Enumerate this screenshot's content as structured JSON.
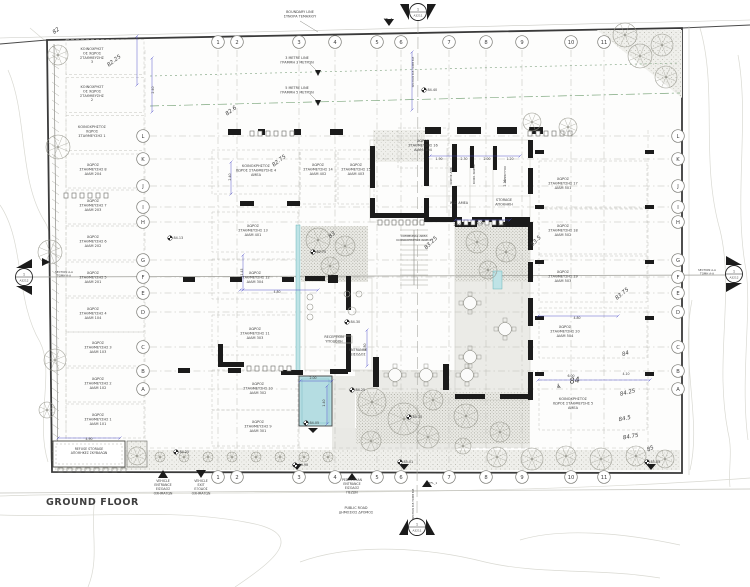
{
  "drawing": {
    "title": "GROUND FLOOR",
    "grid": {
      "columns": [
        {
          "label": "1",
          "x": 218
        },
        {
          "label": "2",
          "x": 237
        },
        {
          "label": "3",
          "x": 299
        },
        {
          "label": "4",
          "x": 335
        },
        {
          "label": "5",
          "x": 377
        },
        {
          "label": "6",
          "x": 401
        },
        {
          "label": "7",
          "x": 449
        },
        {
          "label": "8",
          "x": 486
        },
        {
          "label": "9",
          "x": 522
        },
        {
          "label": "10",
          "x": 571
        },
        {
          "label": "11",
          "x": 604
        }
      ],
      "rows": [
        {
          "label": "L",
          "y": 136
        },
        {
          "label": "K",
          "y": 159
        },
        {
          "label": "J",
          "y": 186
        },
        {
          "label": "I",
          "y": 207
        },
        {
          "label": "H",
          "y": 222
        },
        {
          "label": "G",
          "y": 260
        },
        {
          "label": "F",
          "y": 277
        },
        {
          "label": "E",
          "y": 293
        },
        {
          "label": "D",
          "y": 312
        },
        {
          "label": "C",
          "y": 347
        },
        {
          "label": "B",
          "y": 371
        },
        {
          "label": "A",
          "y": 389
        }
      ]
    },
    "parking_spaces": [
      {
        "lines": [
          "ΚΟΙΝΟΧΡΗΣΤ",
          "ΟΣ ΧΩΡΟΣ",
          "ΣΤΑΘΜΕΥΣΗΣ",
          "3"
        ],
        "x": 92,
        "y": 50,
        "bx": 105,
        "by": 57,
        "bw": 78,
        "bh": 35
      },
      {
        "lines": [
          "ΚΟΙΝΟΧΡΗΣΤ",
          "ΟΣ ΧΩΡΟΣ",
          "ΣΤΑΘΜΕΥΣΗΣ",
          "2"
        ],
        "x": 92,
        "y": 88,
        "bx": 105,
        "by": 95,
        "bw": 78,
        "bh": 35
      },
      {
        "lines": [
          "ΚΟΙΝΟΧΡΗΣΤΟΣ",
          "ΧΩΡΟΣ",
          "ΣΤΑΘΜΕΥΣΗΣ 1"
        ],
        "x": 92,
        "y": 128,
        "bx": 105,
        "by": 133,
        "bw": 78,
        "bh": 35
      },
      {
        "lines": [
          "ΧΩΡΟΣ",
          "ΣΤΑΘΜΕΥΣΗΣ 8",
          "ΔΙΑΜ 204"
        ],
        "x": 93,
        "y": 166,
        "bx": 105,
        "by": 171,
        "bw": 78,
        "bh": 34
      },
      {
        "lines": [
          "ΧΩΡΟΣ",
          "ΣΤΑΘΜΕΥΣΗΣ 7",
          "ΔΙΑΜ 203"
        ],
        "x": 93,
        "y": 202,
        "bx": 105,
        "by": 207,
        "bw": 78,
        "bh": 34
      },
      {
        "lines": [
          "ΧΩΡΟΣ",
          "ΣΤΑΘΜΕΥΣΗΣ 6",
          "ΔΙΑΜ 202"
        ],
        "x": 93,
        "y": 238,
        "bx": 105,
        "by": 243,
        "bw": 78,
        "bh": 34
      },
      {
        "lines": [
          "ΧΩΡΟΣ",
          "ΣΤΑΘΜΕΥΣΗΣ 5",
          "ΔΙΑΜ 201"
        ],
        "x": 93,
        "y": 274,
        "bx": 105,
        "by": 279,
        "bw": 78,
        "bh": 34
      },
      {
        "lines": [
          "ΧΩΡΟΣ",
          "ΣΤΑΘΜΕΥΣΗΣ 4",
          "ΔΙΑΜ 104"
        ],
        "x": 93,
        "y": 310,
        "bx": 105,
        "by": 315,
        "bw": 78,
        "bh": 34
      },
      {
        "lines": [
          "ΧΩΡΟΣ",
          "ΣΤΑΘΜΕΥΣΗΣ 3",
          "ΔΙΑΜ 103"
        ],
        "x": 98,
        "y": 344,
        "bx": 105,
        "by": 349,
        "bw": 78,
        "bh": 34
      },
      {
        "lines": [
          "ΧΩΡΟΣ",
          "ΣΤΑΘΜΕΥΣΗΣ 2",
          "ΔΙΑΜ 102"
        ],
        "x": 98,
        "y": 380,
        "bx": 105,
        "by": 385,
        "bw": 78,
        "bh": 34
      },
      {
        "lines": [
          "ΧΩΡΟΣ",
          "ΣΤΑΘΜΕΥΣΗΣ 1",
          "ΔΙΑΜ 101"
        ],
        "x": 98,
        "y": 416,
        "bx": 105,
        "by": 421,
        "bw": 78,
        "bh": 34
      },
      {
        "lines": [
          "ΚΟΙΝΟΧΡΗΣΤΟΣ",
          "ΧΩΡΟΣ ΣΤΑΘΜΕΥΣΗΣ 4",
          "ΑΜΕΑ"
        ],
        "x": 256,
        "y": 167,
        "bx": 256,
        "by": 172,
        "bw": 88,
        "bh": 44
      },
      {
        "lines": [
          "ΧΩΡΟΣ",
          "ΣΤΑΘΜΕΥΣΗΣ 14",
          "ΔΙΑΜ 402"
        ],
        "x": 318,
        "y": 166,
        "bx": 318,
        "by": 177,
        "bw": 36,
        "bh": 54
      },
      {
        "lines": [
          "ΧΩΡΟΣ",
          "ΣΤΑΘΜΕΥΣΗΣ 15",
          "ΔΙΑΜ 403"
        ],
        "x": 356,
        "y": 166,
        "bx": 356,
        "by": 177,
        "bw": 36,
        "bh": 54
      },
      {
        "lines": [
          "ΧΩΡΟΣ",
          "ΣΤΑΘΜΕΥΣΗΣ 16",
          "ΔΙΑΜ. 404"
        ],
        "x": 423,
        "y": 142,
        "bx": 423,
        "by": 148,
        "bw": 50,
        "bh": 40
      },
      {
        "lines": [
          "ΧΩΡΟΣ",
          "ΣΤΑΘΜΕΥΣΗΣ 13",
          "ΔΙΑΜ 401"
        ],
        "x": 253,
        "y": 227,
        "bx": 255,
        "by": 232,
        "bw": 86,
        "bh": 40
      },
      {
        "lines": [
          "ΧΩΡΟΣ",
          "ΣΤΑΘΜΕΥΣΗΣ 12",
          "ΔΙΑΜ 304"
        ],
        "x": 255,
        "y": 274,
        "bx": 255,
        "by": 279,
        "bw": 86,
        "bh": 40
      },
      {
        "lines": [
          "ΧΩΡΟΣ",
          "ΣΤΑΘΜΕΥΣΗΣ 11",
          "ΔΙΑΜ 303"
        ],
        "x": 255,
        "y": 330,
        "bx": 255,
        "by": 335,
        "bw": 86,
        "bh": 40
      },
      {
        "lines": [
          "ΧΩΡΟΣ",
          "ΣΤΑΘΜΕΥΣΗΣ 10",
          "ΔΙΑΜ 302"
        ],
        "x": 258,
        "y": 385,
        "bx": 255,
        "by": 390,
        "bw": 86,
        "bh": 40
      },
      {
        "lines": [
          "ΧΩΡΟΣ",
          "ΣΤΑΘΜΕΥΣΗΣ 9",
          "ΔΙΑΜ 301"
        ],
        "x": 258,
        "y": 423,
        "bx": 255,
        "by": 428,
        "bw": 86,
        "bh": 36
      },
      {
        "lines": [
          "ΧΩΡΟΣ",
          "ΣΤΑΘΜΕΥΣΗΣ 17",
          "ΔΙΑΜ 501"
        ],
        "x": 563,
        "y": 180,
        "bx": 593,
        "by": 185,
        "bw": 108,
        "bh": 48
      },
      {
        "lines": [
          "ΧΩΡΟΣ",
          "ΣΤΑΘΜΕΥΣΗΣ 18",
          "ΔΙΑΜ 502"
        ],
        "x": 563,
        "y": 227,
        "bx": 593,
        "by": 232,
        "bw": 108,
        "bh": 48
      },
      {
        "lines": [
          "ΧΩΡΟΣ",
          "ΣΤΑΘΜΕΥΣΗΣ 19",
          "ΔΙΑΜ 503"
        ],
        "x": 563,
        "y": 273,
        "bx": 593,
        "by": 278,
        "bw": 108,
        "bh": 48
      },
      {
        "lines": [
          "ΧΩΡΟΣ",
          "ΣΤΑΘΜΕΥΣΗΣ 20",
          "ΔΙΑΜ 504"
        ],
        "x": 565,
        "y": 328,
        "bx": 593,
        "by": 333,
        "bw": 108,
        "bh": 50
      },
      {
        "lines": [
          "ΚΟΙΝΟΧΡΗΣΤΟΣ",
          "ΧΩΡΟΣ ΣΤΑΘΜΕΥΣΗΣ 5",
          "ΑΜΕΑ"
        ],
        "x": 573,
        "y": 400,
        "bx": 593,
        "by": 405,
        "bw": 108,
        "bh": 50
      }
    ],
    "labels": [
      {
        "name": "boundary-line-label",
        "lines": [
          "BOUNDARY LINE",
          "ΣΥΝΟΡΑ ΤΕΜΑΧΙΟΥ"
        ],
        "x": 300,
        "y": 13
      },
      {
        "name": "three-metre-line-label",
        "lines": [
          "3 METRE LINE",
          "ΓΡΑΜΜΗ 3 ΜΕΤΡΩΝ"
        ],
        "x": 297,
        "y": 59
      },
      {
        "name": "five-metre-line-label",
        "lines": [
          "5 METRE LINE",
          "ΓΡΑΜΜΗ 5 ΜΕΤΡΩΝ"
        ],
        "x": 297,
        "y": 89
      },
      {
        "name": "refuse-storage-label",
        "lines": [
          "REFUSE STORAGE",
          "ΑΠΟΘΗΚΕΣ ΣΚΥΒΑΛΩΝ"
        ],
        "x": 89,
        "y": 450,
        "size": 3.2
      },
      {
        "name": "reception-label",
        "lines": [
          "RECEPTION",
          "ΥΠΟΔΟΧΗ"
        ],
        "x": 334,
        "y": 338
      },
      {
        "name": "entrance-label",
        "lines": [
          "ENTRANCE",
          "ΕΙΣΟΔΟΣ"
        ],
        "x": 358,
        "y": 351
      },
      {
        "name": "storage-label",
        "lines": [
          "STORAGE",
          "ΑΠΟΘΗΚΗ"
        ],
        "x": 504,
        "y": 201
      },
      {
        "name": "wc-amea-label",
        "lines": [
          "W.C. ΑΜΕΑ"
        ],
        "x": 459,
        "y": 204
      },
      {
        "name": "communal-area-label",
        "lines": [
          "COMMUNAL AREA",
          "ΚΟΙΝΟΧΡΗΣΤΟΣ ΧΩΡΟΣ"
        ],
        "x": 414,
        "y": 237,
        "size": 3.0
      },
      {
        "name": "ahk-room-label",
        "lines": [
          "ΧΩΡΟΣ ΑΗΚ"
        ],
        "x": 452,
        "y": 176,
        "rot": -90,
        "size": 3.0
      },
      {
        "name": "koin-room-label",
        "lines": [
          "ΚΟΙΝ. ΧΩΡΟΣ"
        ],
        "x": 475,
        "y": 174,
        "rot": -90,
        "size": 3.0
      },
      {
        "name": "elek-room-label",
        "lines": [
          "ΗΛΕΚΤΥΟΣ"
        ],
        "x": 506,
        "y": 174,
        "rot": -90,
        "size": 3.0
      },
      {
        "name": "vehicle-entrance-label",
        "lines": [
          "VEHICLE",
          "ENTRANCE",
          "ΕΙΣΟΔΟΣ",
          "ΟΧΗΜΑΤΩΝ"
        ],
        "x": 163,
        "y": 482,
        "size": 3.2
      },
      {
        "name": "vehicle-exit-label",
        "lines": [
          "VEHICLE",
          "EXIT",
          "ΕΞΟΔΟΣ",
          "ΟΧΗΜΑΤΩΝ"
        ],
        "x": 201,
        "y": 482,
        "size": 3.2
      },
      {
        "name": "pedestrian-entrance-label",
        "lines": [
          "PEDESTRIAN",
          "ENTRANCE",
          "ΕΙΣΟΔΟΣ",
          "ΠΕΖΩΝ"
        ],
        "x": 352,
        "y": 481,
        "size": 3.2
      },
      {
        "name": "public-road-label",
        "lines": [
          "PUBLIC ROAD",
          "ΔΗΜΟΣΙΟΣ ΔΡΟΜΟΣ"
        ],
        "x": 356,
        "y": 509
      },
      {
        "name": "section-aa-left-label",
        "lines": [
          "SECTION A-A",
          "ΤΟΜΗ A-A"
        ],
        "x": 64,
        "y": 273,
        "size": 2.8
      },
      {
        "name": "section-aa-right-label",
        "lines": [
          "SECTION A-A",
          "ΤΟΜΗ A-A"
        ],
        "x": 707,
        "y": 271,
        "size": 2.8
      },
      {
        "name": "section-bb-top-label",
        "lines": [
          "SECTION B-B  ΤΟΜΗ B-B"
        ],
        "x": 414,
        "y": 72,
        "rot": -90,
        "size": 2.6
      },
      {
        "name": "section-bb-bottom-label",
        "lines": [
          "SECTION B-B  ΤΟΜΗ B-B"
        ],
        "x": 414,
        "y": 504,
        "rot": -90,
        "size": 2.6
      },
      {
        "name": "tfl3-label",
        "lines": [
          "TFL_3"
        ],
        "x": 388,
        "y": 20,
        "size": 3.0
      },
      {
        "name": "tfl1-label",
        "lines": [
          "TFL_1"
        ],
        "x": 433,
        "y": 484,
        "size": 3.0
      }
    ],
    "section_markers": [
      {
        "num": "1",
        "sheet": "A3211",
        "x": 418,
        "y": 12,
        "dir": "top"
      },
      {
        "num": "1",
        "sheet": "A3211",
        "x": 417,
        "y": 527,
        "dir": "bottom"
      },
      {
        "num": "1",
        "sheet": "A3212",
        "x": 24,
        "y": 277,
        "dir": "left"
      },
      {
        "num": "1",
        "sheet": "A3212",
        "x": 734,
        "y": 274,
        "dir": "right"
      }
    ],
    "spot_elevations": [
      {
        "value": "84.13",
        "x": 170,
        "y": 238
      },
      {
        "value": "82.70",
        "x": 313,
        "y": 252
      },
      {
        "value": "84.30",
        "x": 347,
        "y": 322
      },
      {
        "value": "84.25",
        "x": 352,
        "y": 390
      },
      {
        "value": "84.05",
        "x": 306,
        "y": 423
      },
      {
        "value": "84.15",
        "x": 409,
        "y": 417
      },
      {
        "value": "84.25",
        "x": 176,
        "y": 452
      },
      {
        "value": "84.40",
        "x": 424,
        "y": 90
      },
      {
        "value": "84.90",
        "x": 295,
        "y": 465
      },
      {
        "value": "85.01",
        "x": 400,
        "y": 462
      },
      {
        "value": "85.03",
        "x": 647,
        "y": 462
      }
    ],
    "contour_labels": [
      {
        "value": "82",
        "x": 57,
        "y": 32,
        "rot": -38
      },
      {
        "value": "82.25",
        "x": 115,
        "y": 62,
        "rot": -38
      },
      {
        "value": "82.6",
        "x": 232,
        "y": 112,
        "rot": -38
      },
      {
        "value": "82.75",
        "x": 280,
        "y": 162,
        "rot": -38
      },
      {
        "value": "83",
        "x": 333,
        "y": 236,
        "rot": -42
      },
      {
        "value": "83.25",
        "x": 432,
        "y": 244,
        "rot": -45
      },
      {
        "value": "83.5",
        "x": 537,
        "y": 242,
        "rot": -45
      },
      {
        "value": "83.75",
        "x": 623,
        "y": 295,
        "rot": -40
      },
      {
        "value": "84",
        "x": 626,
        "y": 355,
        "rot": -18
      },
      {
        "value": "84",
        "x": 575,
        "y": 383,
        "rot": -8,
        "size": 8
      },
      {
        "value": "84.25",
        "x": 628,
        "y": 394,
        "rot": -14
      },
      {
        "value": "84.5",
        "x": 625,
        "y": 420,
        "rot": -12
      },
      {
        "value": "84.75",
        "x": 631,
        "y": 438,
        "rot": -10
      },
      {
        "value": "85",
        "x": 651,
        "y": 450,
        "rot": -25
      }
    ],
    "dimensions": [
      {
        "value": "1.90",
        "x": 439,
        "y": 160
      },
      {
        "value": "2.30",
        "x": 464,
        "y": 160
      },
      {
        "value": "2.00",
        "x": 487,
        "y": 160
      },
      {
        "value": "1.20",
        "x": 510,
        "y": 160
      },
      {
        "value": "2.90",
        "x": 457,
        "y": 226
      },
      {
        "value": "2.00",
        "x": 480,
        "y": 224
      },
      {
        "value": "2.90",
        "x": 502,
        "y": 226
      },
      {
        "value": "2.10",
        "x": 506,
        "y": 183,
        "rot": -90
      },
      {
        "value": "2.40",
        "x": 231,
        "y": 177,
        "rot": -90
      },
      {
        "value": "4.80",
        "x": 277,
        "y": 293
      },
      {
        "value": "1.45",
        "x": 243,
        "y": 272,
        "rot": -90
      },
      {
        "value": "2.00",
        "x": 313,
        "y": 379
      },
      {
        "value": "1.40",
        "x": 325,
        "y": 403,
        "rot": -90
      },
      {
        "value": "4.80",
        "x": 366,
        "y": 347,
        "rot": -90
      },
      {
        "value": "4.80",
        "x": 577,
        "y": 319
      },
      {
        "value": "6.00",
        "x": 571,
        "y": 377
      },
      {
        "value": "4.10",
        "x": 626,
        "y": 375
      },
      {
        "value": "2.40",
        "x": 154,
        "y": 90,
        "rot": -90
      },
      {
        "value": "4.90",
        "x": 89,
        "y": 440
      }
    ]
  }
}
